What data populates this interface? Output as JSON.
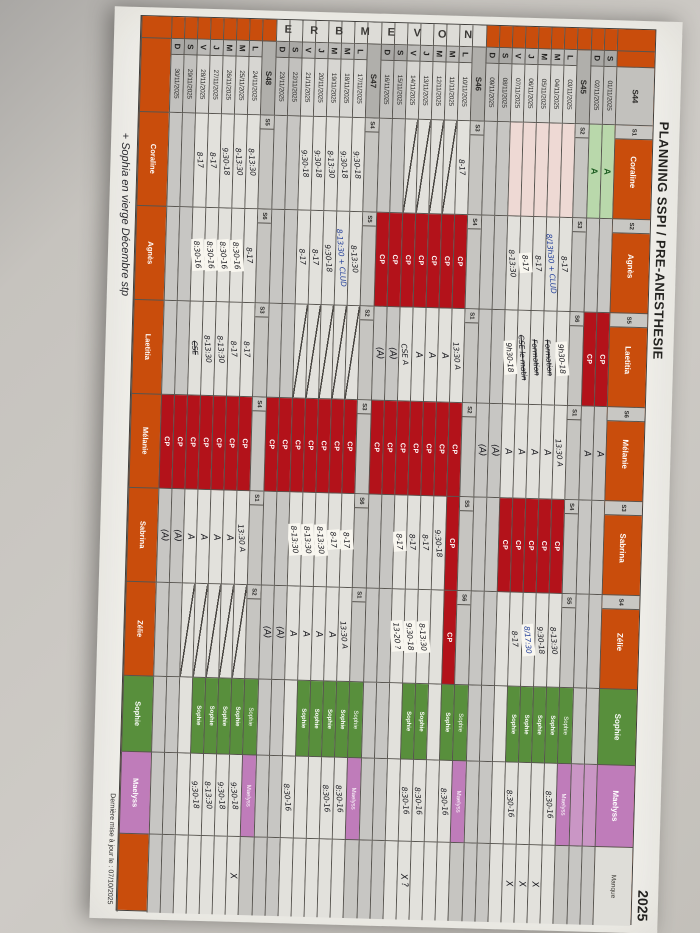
{
  "title": "PLANNING SSPI / PRE-ANESTHESIE",
  "year": "2025",
  "month": "NOVEMBRE",
  "notes": {
    "update": "Dernière mise à jour le : 07/10/2025",
    "handwritten": "+ Sophia en vierge Décembre stp"
  },
  "colors": {
    "orange": "#c94d0c",
    "red": "#b3121a",
    "green": "#588f3c",
    "light_green": "#b9d8ab",
    "pink": "#bf7cba"
  },
  "staff": [
    {
      "name": "Coraline",
      "style": "orange"
    },
    {
      "name": "Agnès",
      "style": "orange"
    },
    {
      "name": "Laetitia",
      "style": "orange"
    },
    {
      "name": "Mélanie",
      "style": "orange"
    },
    {
      "name": "Sabrina",
      "style": "orange"
    },
    {
      "name": "Zélie",
      "style": "orange"
    },
    {
      "name": "Sophie",
      "style": "green"
    },
    {
      "name": "Maelyss",
      "style": "pink"
    },
    {
      "name": "Manque",
      "style": "plain"
    }
  ],
  "footer_names": [
    "Coraline",
    "Agnès",
    "Laetitia",
    "Mélanie",
    "Sabrina",
    "Zélie",
    "Sophie",
    "Maelyss",
    ""
  ],
  "weeks": [
    {
      "label": "S44",
      "own_header": false,
      "month_cell": "orange",
      "codes": [
        "S1",
        "S2",
        "S5",
        "S6",
        "S3",
        "S4",
        "",
        "",
        ""
      ],
      "days": [
        {
          "letter": "S",
          "date": "01/11/2025",
          "weekend": true
        },
        {
          "letter": "D",
          "date": "02/11/2025",
          "weekend": true
        }
      ],
      "cells": [
        [
          "gA",
          "gA"
        ],
        [
          "/",
          "/"
        ],
        [
          "CP",
          "CP"
        ],
        [
          "A",
          "A"
        ],
        [
          "/",
          "/"
        ],
        [
          "/",
          "/"
        ],
        [
          "",
          ""
        ],
        [
          "p",
          "p"
        ],
        [
          "",
          ""
        ]
      ]
    },
    {
      "label": "S45",
      "own_header": true,
      "month_cell": "orange",
      "codes": [
        "S2",
        "S3",
        "S6",
        "S1",
        "S4",
        "S5",
        "",
        "",
        ""
      ],
      "days": [
        {
          "letter": "L",
          "date": "03/11/2025",
          "weekend": false
        },
        {
          "letter": "M",
          "date": "04/11/2025",
          "weekend": false
        },
        {
          "letter": "M",
          "date": "05/11/2025",
          "weekend": false
        },
        {
          "letter": "J",
          "date": "06/11/2025",
          "weekend": false
        },
        {
          "letter": "V",
          "date": "07/11/2025",
          "weekend": false
        },
        {
          "letter": "S",
          "date": "08/11/2025",
          "weekend": true
        },
        {
          "letter": "D",
          "date": "09/11/2025",
          "weekend": true
        }
      ],
      "cells": [
        [
          "p/",
          "p/",
          "p/",
          "p/",
          "p/",
          "/",
          "/"
        ],
        [
          "8-17",
          "b:8/13h30 + CLUD",
          "8-17",
          "*8-17",
          "8-13:30",
          "/",
          "/"
        ],
        [
          "*9h30-18",
          "s:Formation",
          "s:Formation",
          "s:CSE le matin",
          "*9h30-18",
          "/",
          "/"
        ],
        [
          "13:30 A",
          "A",
          "A",
          "A",
          "A",
          "(A)",
          "(A)"
        ],
        [
          "CP",
          "CP",
          "CP",
          "CP",
          "CP",
          "/",
          "/"
        ],
        [
          "8-13:30",
          "9:30-18",
          "*b:8/17:30",
          "8-17",
          "",
          "/",
          "/"
        ],
        [
          "Sophie",
          "Sophie",
          "Sophie",
          "Sophie",
          "",
          "",
          ""
        ],
        [
          "8:30-16",
          "",
          "",
          "8:30-16",
          "",
          "",
          ""
        ],
        [
          "",
          "X",
          "X",
          "X",
          "",
          "",
          ""
        ]
      ]
    },
    {
      "label": "S46",
      "own_header": true,
      "month_cell": "plain",
      "codes": [
        "S3",
        "S4",
        "S1",
        "S2",
        "S5",
        "S6",
        "",
        "",
        ""
      ],
      "days": [
        {
          "letter": "L",
          "date": "10/11/2025",
          "weekend": false
        },
        {
          "letter": "M",
          "date": "11/11/2025",
          "weekend": false
        },
        {
          "letter": "M",
          "date": "12/11/2025",
          "weekend": false
        },
        {
          "letter": "J",
          "date": "13/11/2025",
          "weekend": false
        },
        {
          "letter": "V",
          "date": "14/11/2025",
          "weekend": false
        },
        {
          "letter": "S",
          "date": "15/11/2025",
          "weekend": true
        },
        {
          "letter": "D",
          "date": "16/11/2025",
          "weekend": true
        }
      ],
      "cells": [
        [
          "8-17",
          "/",
          "/",
          "/",
          "/",
          "/",
          "/"
        ],
        [
          "CP",
          "CP",
          "CP",
          "CP",
          "CP",
          "CP",
          "CP"
        ],
        [
          "13:30 A",
          "A",
          "A",
          "A",
          "CSE A",
          "(A)",
          "(A)"
        ],
        [
          "CP",
          "CP",
          "CP",
          "CP",
          "CP",
          "CP",
          "CP"
        ],
        [
          "CP",
          "9:30-18",
          "8-17",
          "8-17",
          "*8-17",
          "/",
          "/"
        ],
        [
          "CP",
          "",
          "*8-13:30",
          "*9:30-18",
          "*13-20 ?",
          "/",
          "/"
        ],
        [
          "Sophie",
          "",
          "Sophie",
          "Sophie",
          "",
          "",
          ""
        ],
        [
          "8:30-16",
          "",
          "8:30-16",
          "8:30-16",
          "",
          "",
          ""
        ],
        [
          "",
          "",
          "",
          "X ?",
          "",
          "",
          ""
        ]
      ]
    },
    {
      "label": "S47",
      "own_header": true,
      "month_cell": "plain",
      "codes": [
        "S4",
        "S5",
        "S2",
        "S3",
        "S6",
        "S1",
        "",
        "",
        ""
      ],
      "days": [
        {
          "letter": "L",
          "date": "17/11/2025",
          "weekend": false
        },
        {
          "letter": "M",
          "date": "18/11/2025",
          "weekend": false
        },
        {
          "letter": "M",
          "date": "19/11/2025",
          "weekend": false
        },
        {
          "letter": "J",
          "date": "20/11/2025",
          "weekend": false
        },
        {
          "letter": "V",
          "date": "21/11/2025",
          "weekend": false
        },
        {
          "letter": "S",
          "date": "22/11/2025",
          "weekend": true
        },
        {
          "letter": "D",
          "date": "23/11/2025",
          "weekend": true
        }
      ],
      "cells": [
        [
          "9:30-18",
          "9:30-18",
          "8-13:30",
          "9:30-18",
          "9:30-18",
          "/",
          "/"
        ],
        [
          "8-13:30",
          "b:8-13:30 + CLUD",
          "9:30-18",
          "8-17",
          "8-17",
          "/",
          "/"
        ],
        [
          "/",
          "/",
          "/",
          "/",
          "/",
          "/",
          "/"
        ],
        [
          "CP",
          "CP",
          "CP",
          "CP",
          "CP",
          "CP",
          "CP"
        ],
        [
          "*8-17",
          "*8-17",
          "*8-13:30",
          "*8-13:30",
          "*8-13:30",
          "/",
          "/"
        ],
        [
          "13:30 A",
          "A",
          "A",
          "A",
          "A",
          "(A)",
          "(A)"
        ],
        [
          "Sophie",
          "Sophie",
          "Sophie",
          "Sophie",
          "",
          "",
          ""
        ],
        [
          "8:30-16",
          "8:30-16",
          "",
          "",
          "8:30-16",
          "",
          ""
        ],
        [
          "",
          "",
          "",
          "",
          "",
          "",
          ""
        ]
      ]
    },
    {
      "label": "S48",
      "own_header": true,
      "month_cell": "orange",
      "codes": [
        "S5",
        "S6",
        "S3",
        "S4",
        "S1",
        "S2",
        "",
        "",
        ""
      ],
      "days": [
        {
          "letter": "L",
          "date": "24/11/2025",
          "weekend": false
        },
        {
          "letter": "M",
          "date": "25/11/2025",
          "weekend": false
        },
        {
          "letter": "M",
          "date": "26/11/2025",
          "weekend": false
        },
        {
          "letter": "J",
          "date": "27/11/2025",
          "weekend": false
        },
        {
          "letter": "V",
          "date": "28/11/2025",
          "weekend": false
        },
        {
          "letter": "S",
          "date": "29/11/2025",
          "weekend": true
        },
        {
          "letter": "D",
          "date": "30/11/2025",
          "weekend": true
        }
      ],
      "cells": [
        [
          "8-13:30",
          "8-13:30",
          "9:30-18",
          "8-17",
          "8-17",
          "/",
          "/"
        ],
        [
          "8-17",
          "*8:30-16",
          "*8:30-16",
          "*8:30-16",
          "*8:30-16",
          "/",
          "/"
        ],
        [
          "8-17",
          "8-17",
          "8-13:30",
          "8-13:30",
          "s:CSE",
          "/",
          "/"
        ],
        [
          "CP",
          "CP",
          "CP",
          "CP",
          "CP",
          "CP",
          "CP"
        ],
        [
          "13:30 A",
          "A",
          "A",
          "A",
          "A",
          "(A)",
          "(A)"
        ],
        [
          "/",
          "/",
          "/",
          "/",
          "/",
          "/",
          "/"
        ],
        [
          "Sophie",
          "Sophie",
          "Sophie",
          "Sophie",
          "",
          "",
          ""
        ],
        [
          "9:30-18",
          "9:30-18",
          "8-13:30",
          "9:30-18",
          "",
          "",
          ""
        ],
        [
          "X",
          "",
          "",
          "",
          "",
          "",
          ""
        ]
      ]
    }
  ]
}
